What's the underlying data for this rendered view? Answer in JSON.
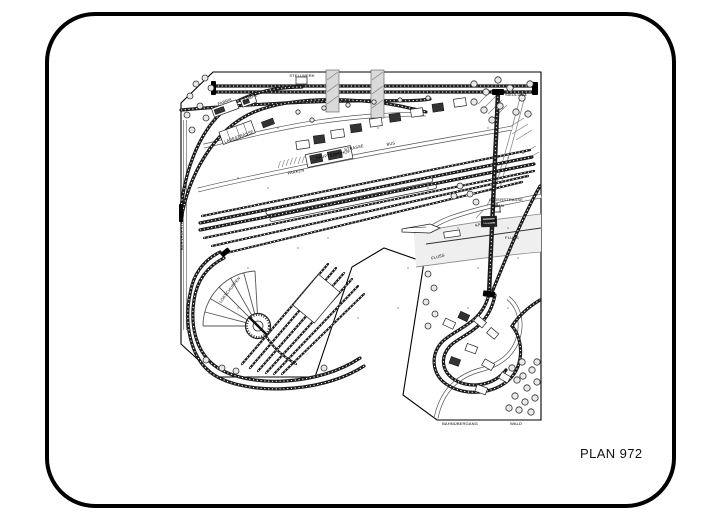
{
  "page": {
    "background": "#ffffff",
    "frame_border_color": "#000000"
  },
  "plan": {
    "number": "PLAN 972",
    "type": "model-railway-track-plan",
    "labels": [
      {
        "text": "STELLWERK"
      },
      {
        "text": "SIEDLUNG"
      },
      {
        "text": "FABRIK"
      },
      {
        "text": "RAMPE"
      },
      {
        "text": "LADESTRASSE"
      },
      {
        "text": "HAUPTBAHNHOF"
      },
      {
        "text": "PARKEN"
      },
      {
        "text": "STRASSE"
      },
      {
        "text": "BUS"
      },
      {
        "text": "LAGERSTRASSE"
      },
      {
        "text": "KRAN"
      },
      {
        "text": "KAIMAUER"
      },
      {
        "text": "FLUSS"
      },
      {
        "text": "FLUSS"
      },
      {
        "text": "BAHNHOFSTRASSE"
      },
      {
        "text": "LOKSCHUPPEN"
      },
      {
        "text": "BAHNÜBERGANG"
      },
      {
        "text": "WALD"
      }
    ]
  }
}
